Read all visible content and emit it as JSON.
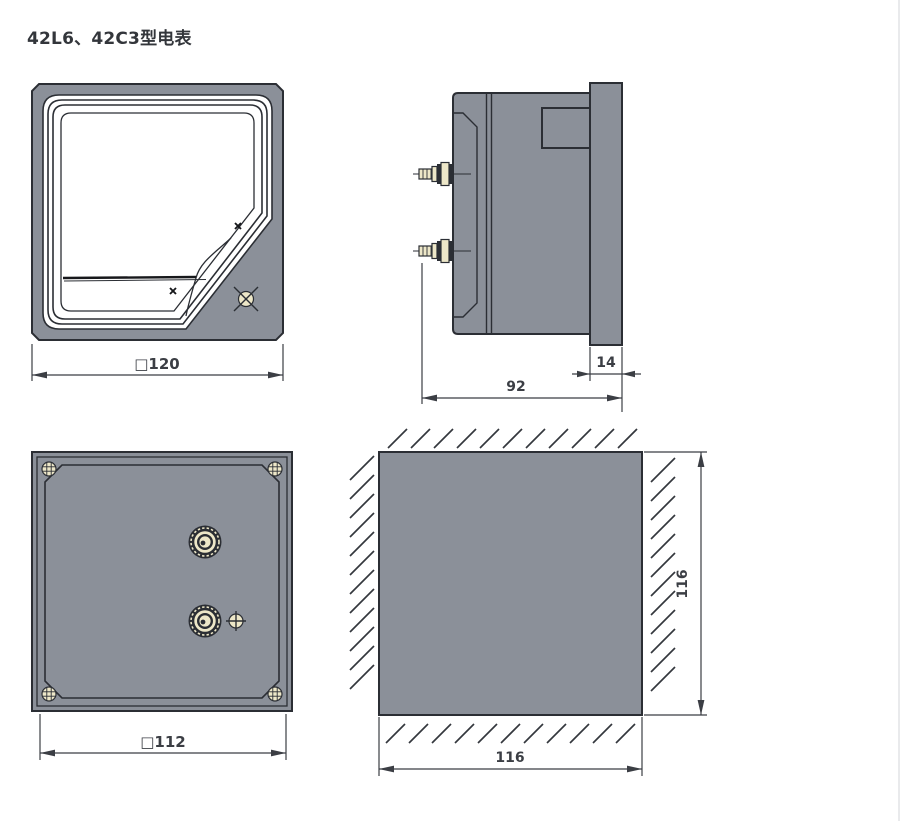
{
  "title": "42L6、42C3型电表",
  "colors": {
    "body_gray": "#8b9099",
    "outline": "#2b2e34",
    "brass": "#ede7c8",
    "dim": "#3b3e44"
  },
  "dimensions": {
    "front_width": "□120",
    "side_depth": "92",
    "bezel_depth": "14",
    "back_width": "□112",
    "cutout_width": "116",
    "cutout_height": "116"
  }
}
